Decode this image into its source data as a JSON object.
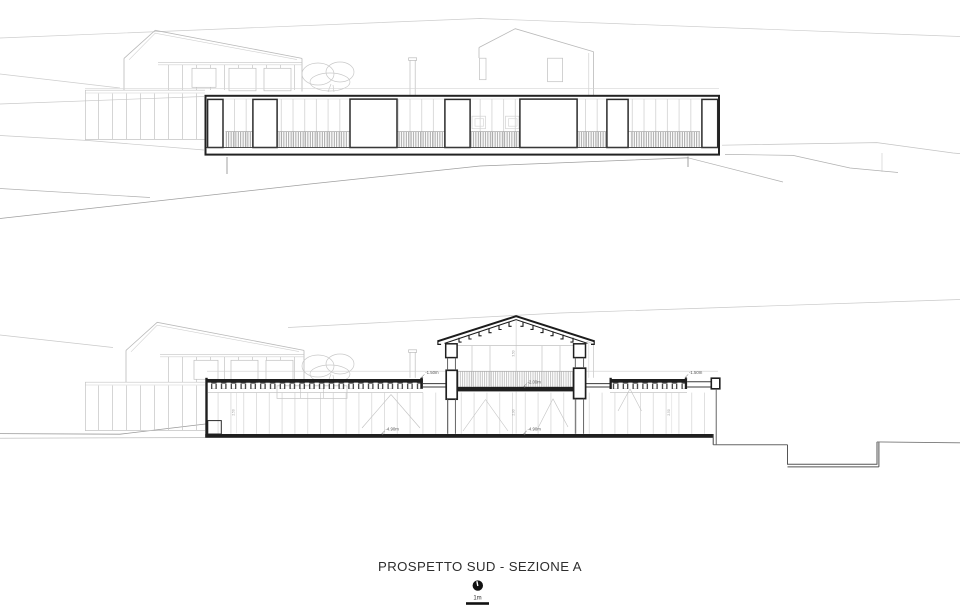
{
  "sheet": {
    "title": "PROSPETTO SUD - SEZIONE A"
  },
  "scale": {
    "icon": "north-indicator-icon",
    "label": "1m"
  },
  "section": {
    "levels": [
      {
        "id": "parapet-left",
        "text": "-1.50m"
      },
      {
        "id": "parapet-right",
        "text": "-1.50m"
      },
      {
        "id": "courtyard-floor",
        "text": "-2.00m"
      },
      {
        "id": "basement-center",
        "text": "-4.90m"
      },
      {
        "id": "basement-left",
        "text": "-4.90m"
      }
    ],
    "dims": [
      {
        "id": "gable-height",
        "text": "3.50"
      },
      {
        "id": "basement-height",
        "text": "2.90"
      },
      {
        "id": "wing-height-left",
        "text": "2.50"
      },
      {
        "id": "wing-height-right",
        "text": "2.50"
      }
    ]
  }
}
